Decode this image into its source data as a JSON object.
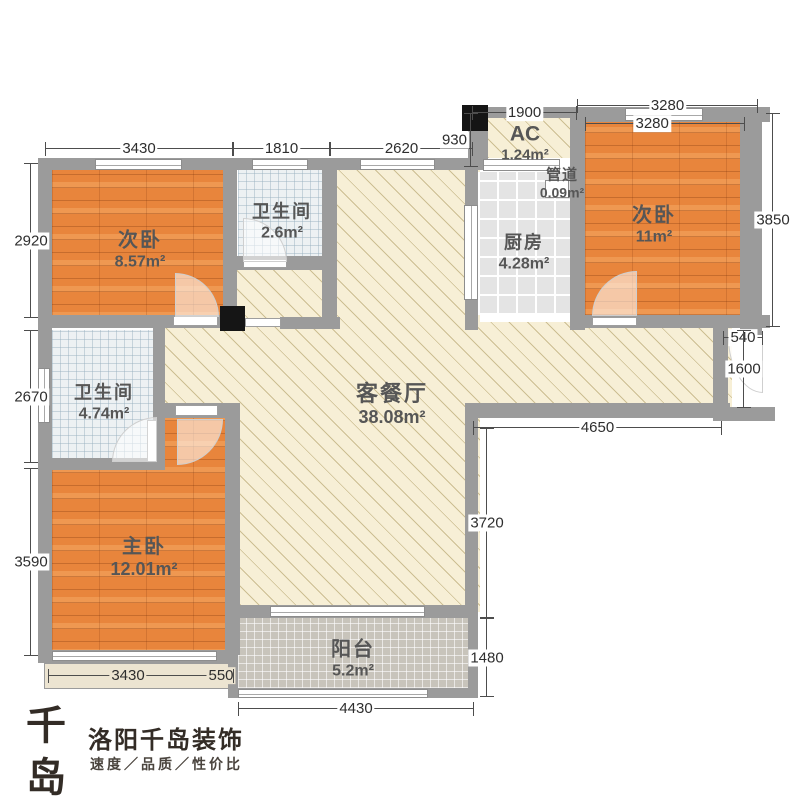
{
  "rooms": [
    {
      "name": "次卧",
      "area": "8.57m²"
    },
    {
      "name": "卫生间",
      "area": "2.6m²"
    },
    {
      "name": "卫生间",
      "area": "4.74m²"
    },
    {
      "name": "主卧",
      "area": "12.01m²"
    },
    {
      "name": "客餐厅",
      "area": "38.08m²"
    },
    {
      "name": "阳台",
      "area": "5.2m²"
    },
    {
      "name": "厨房",
      "area": "4.28m²"
    },
    {
      "name": "AC",
      "area": "1.24m²"
    },
    {
      "name": "管道",
      "area": "0.09m²"
    },
    {
      "name": "次卧",
      "area": "11m²"
    }
  ],
  "dims": [
    "3430",
    "1810",
    "2620",
    "930",
    "1900",
    "3280",
    "3280",
    "3850",
    "540",
    "1600",
    "4650",
    "3720",
    "1480",
    "4430",
    "3430",
    "550",
    "2920",
    "2670",
    "3590"
  ],
  "logo": {
    "mark": "千岛",
    "mark_sub": "QIANDAO",
    "company": "洛阳千岛装饰",
    "tagline": "速度／品质／性价比"
  },
  "colors": {
    "wall": "#9b9b9b",
    "wood_floor": "#e8853c",
    "living_floor": "#f7efd6",
    "bath_tile": "#edf1f3",
    "kitchen_tile": "#e4e4e4",
    "balcony_tile": "#c8c4bb",
    "column_marker": "#151515",
    "dimension_text": "#2e2e2e",
    "label_text": "#565656"
  }
}
